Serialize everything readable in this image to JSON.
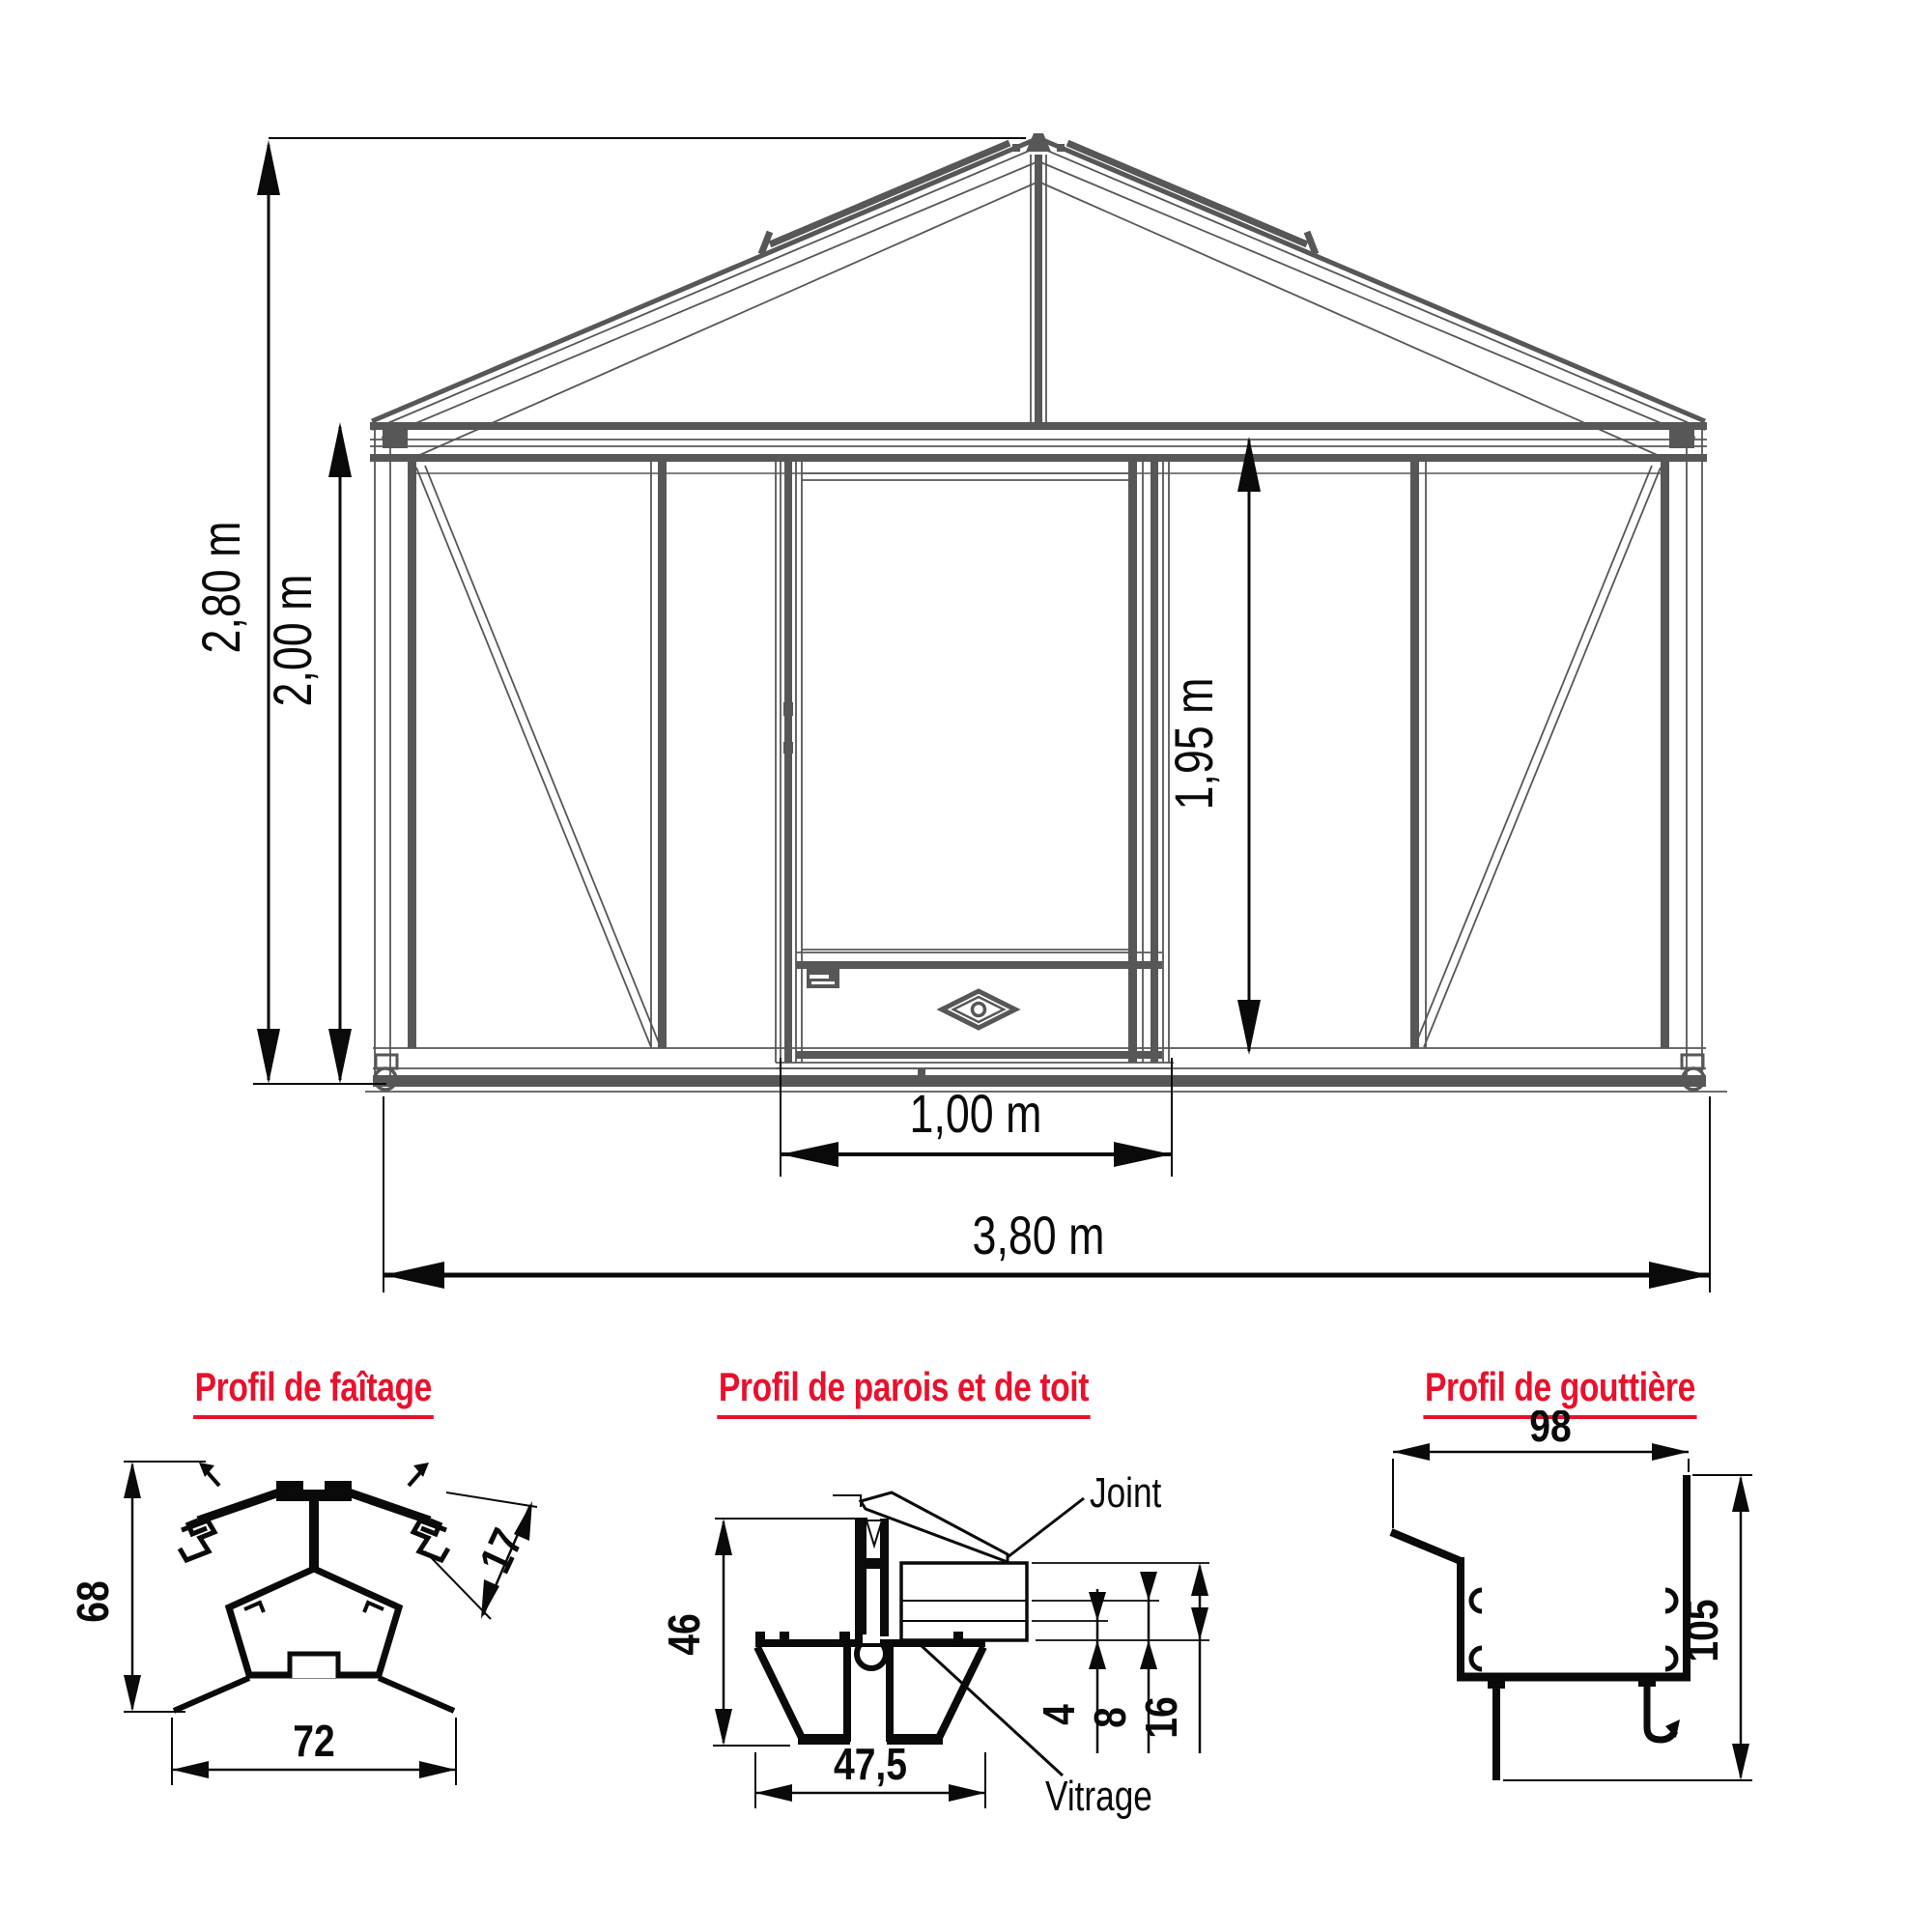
{
  "elevation": {
    "description": "Greenhouse front elevation technical drawing",
    "dims": {
      "total_height": "2,80 m",
      "wall_height": "2,00 m",
      "door_height": "1,95 m",
      "door_width": "1,00 m",
      "total_width": "3,80 m"
    }
  },
  "profiles": {
    "ridge": {
      "title": "Profil de faîtage",
      "height_mm": "68",
      "bar_thickness_mm": "17",
      "width_mm": "72"
    },
    "wall_roof": {
      "title": "Profil de parois et de toit",
      "joint_label": "Joint",
      "glazing_label": "Vitrage",
      "height_mm": "46",
      "pane_mm": "4",
      "gap_mm": "8",
      "total_glazing_mm": "16",
      "width_mm": "47,5"
    },
    "gutter": {
      "title": "Profil de gouttière",
      "width_mm": "98",
      "height_mm": "105"
    }
  },
  "colors": {
    "accent_red": "#e8112d",
    "drawing_gray": "#575757",
    "dimension_black": "#0a0a0a"
  }
}
